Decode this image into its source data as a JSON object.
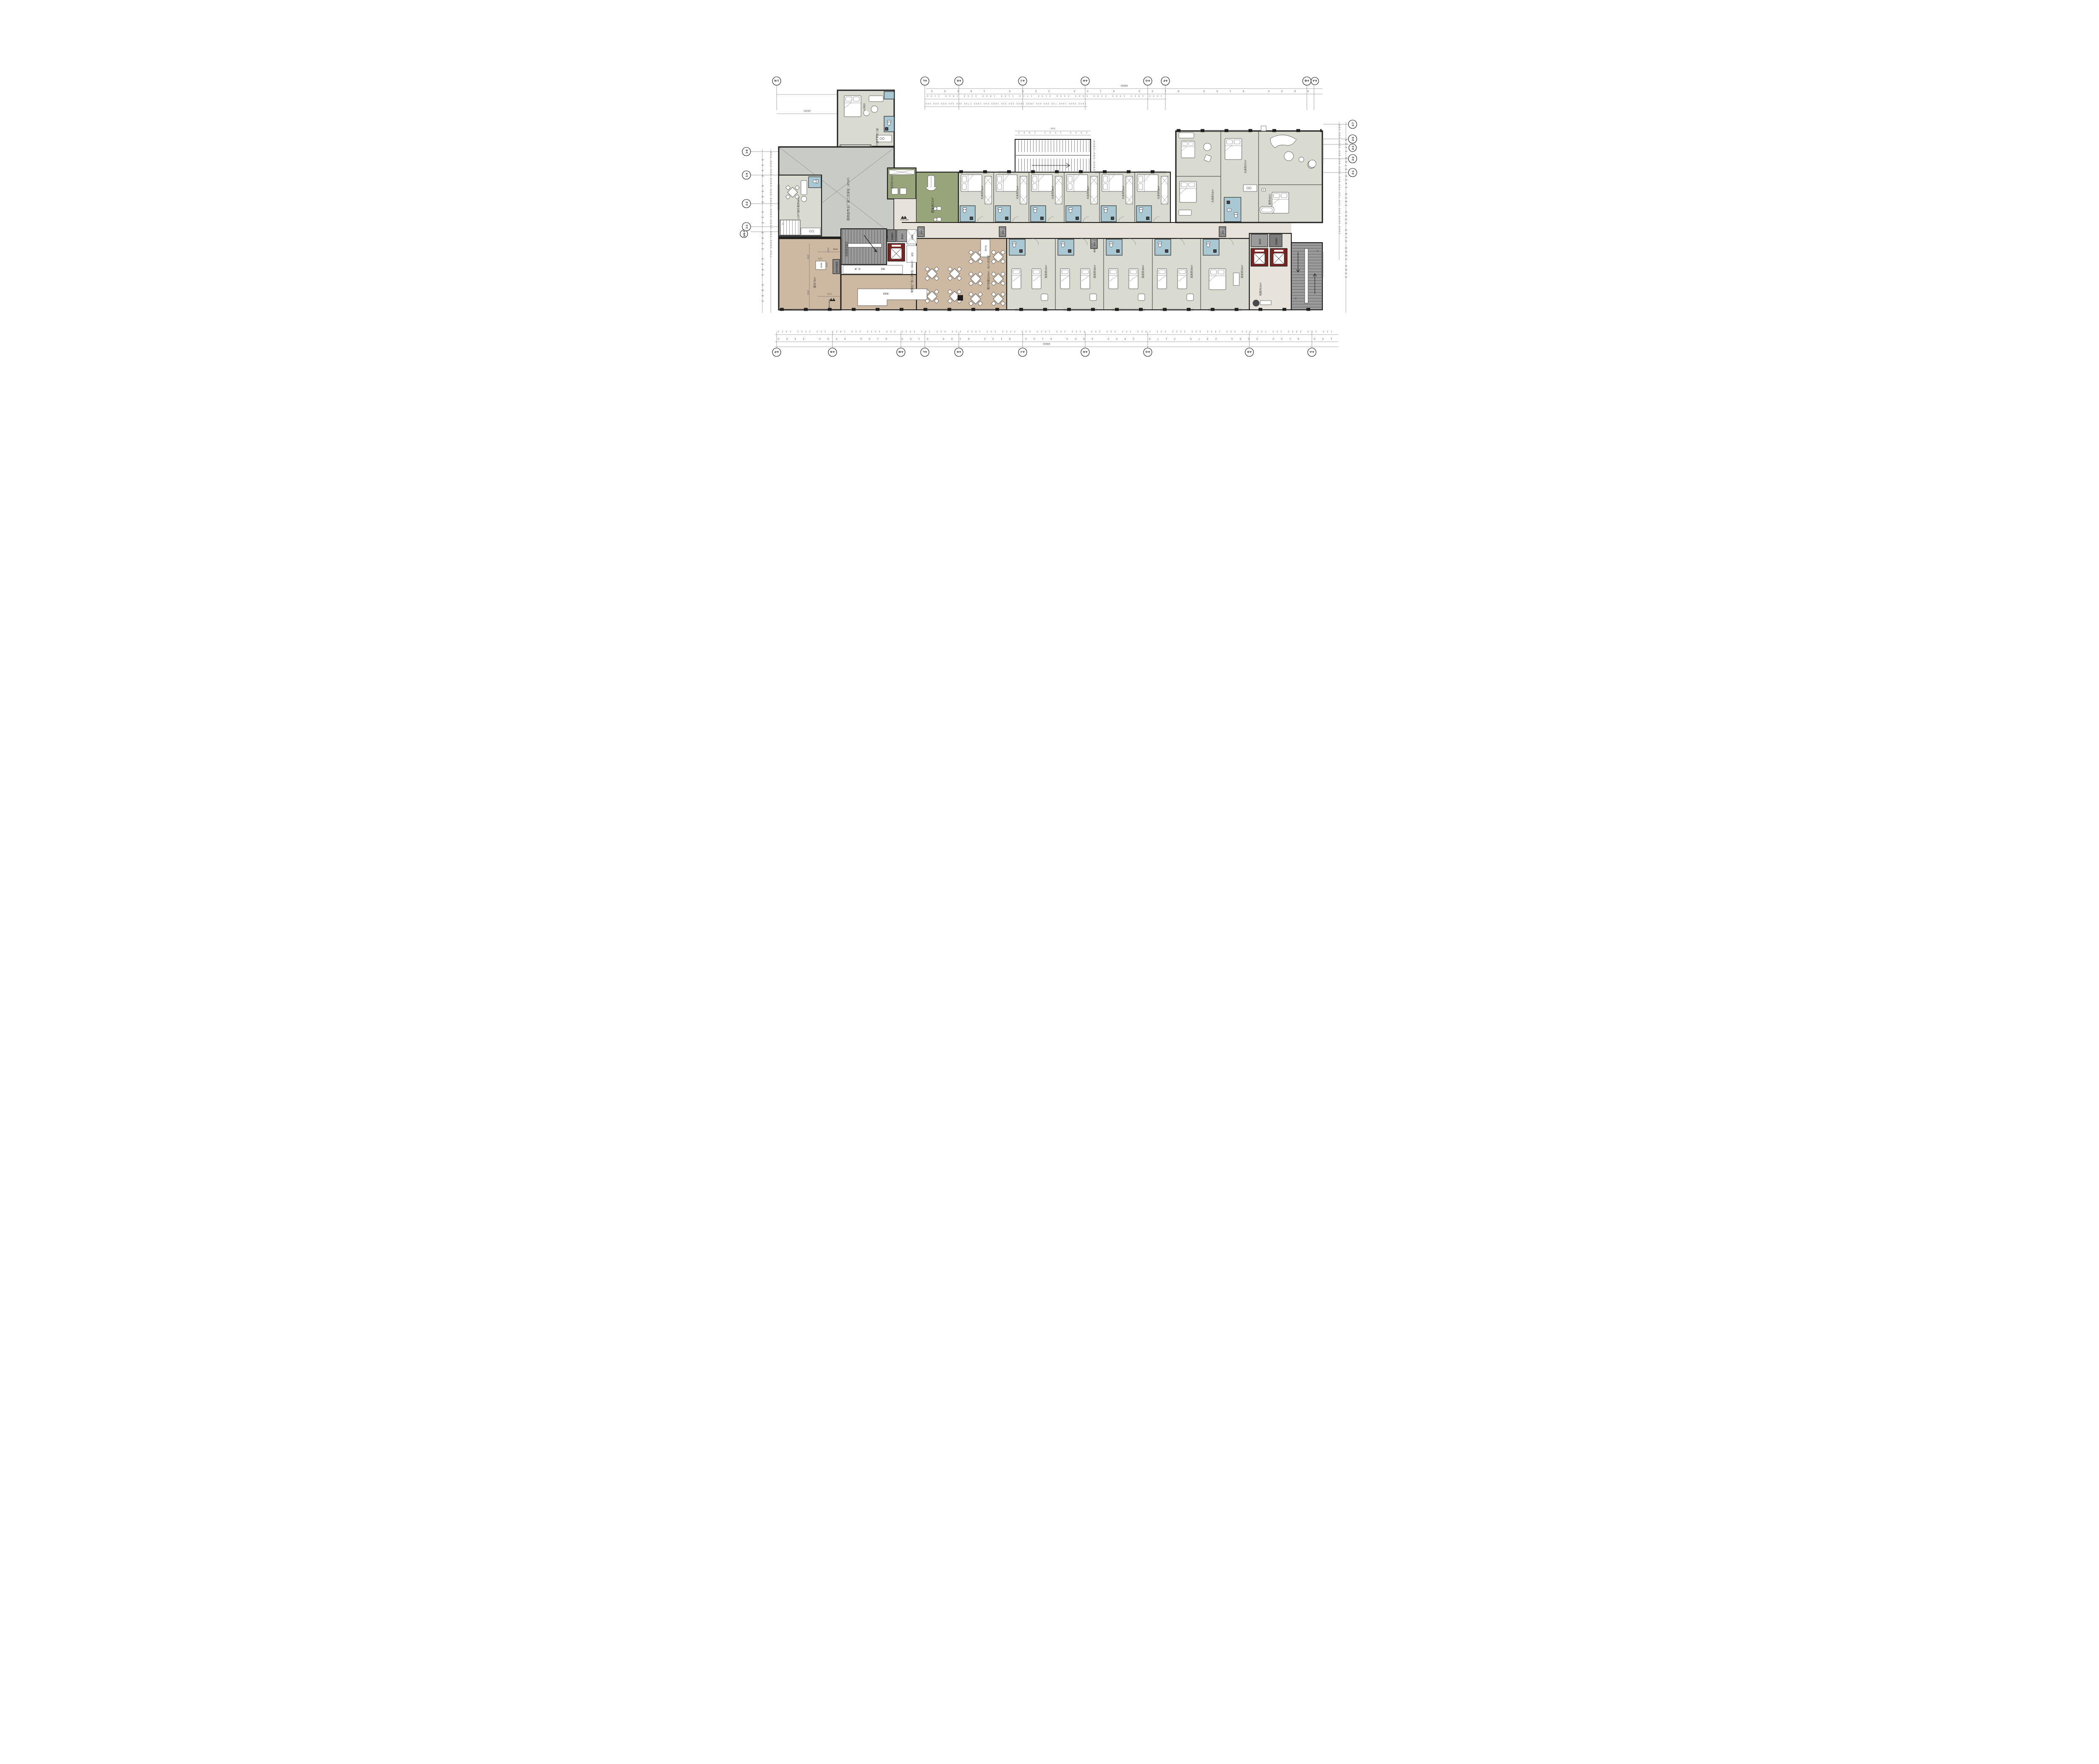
{
  "colors": {
    "room": "#d9dbd1",
    "bath": "#a9c8d3",
    "olive": "#98a57b",
    "tan": "#cdb9a2",
    "corridor": "#e8e3da",
    "core_gray": "#9b9b9b",
    "shaft_gray": "#7c7c7c",
    "void_gray": "#c9ccc6",
    "elevator_red": "#7e2420",
    "wall": "#1d1d1d"
  },
  "grid": {
    "top_labels": [
      "1-N",
      "4-L",
      "4-K",
      "4-J",
      "4-H",
      "4-G",
      "4-F",
      "4-B",
      "4-A"
    ],
    "bottom_labels": [
      "4-P",
      "4-N",
      "4-M",
      "4-L",
      "4-K",
      "4-J",
      "4-H",
      "4-G",
      "4-D",
      "4-A"
    ],
    "left_labels": [
      "1-6",
      "1-4",
      "1-2",
      "1-1",
      "1/4-3"
    ],
    "right_labels": [
      "2-7",
      "2-5",
      "2-3",
      "2-2",
      "2-1"
    ]
  },
  "dims": {
    "total_top": "69600",
    "total_bottom": "69600",
    "block_left": "19000",
    "top_spans": [
      "4600",
      "8100",
      "8100",
      "8100",
      "2250",
      "18000"
    ],
    "top_segs": [
      "1400",
      "1800",
      "1400",
      "2200",
      "5900",
      "3300",
      "3100",
      "1700",
      "1150",
      "1800",
      "2200",
      "1800",
      "1150"
    ],
    "top_fine": [
      "1400",
      "1800",
      "1400",
      "700",
      "900",
      "600",
      "1800",
      "1800",
      "550",
      "350",
      "1400",
      "500",
      "1800",
      "2700",
      "900",
      "300",
      "500",
      "900",
      "500"
    ],
    "bottom_mid": [
      "100",
      "8100",
      "3550",
      "2375",
      "2175",
      "2800",
      "4600",
      "8100",
      "8100",
      "8100",
      "5100",
      "8100",
      "4550",
      "3550"
    ],
    "bottom_fine": [
      "100",
      "500",
      "5800",
      "300",
      "900",
      "300",
      "300",
      "1800",
      "300",
      "3300",
      "300",
      "1800",
      "300",
      "900",
      "300",
      "6000",
      "300",
      "1800",
      "300",
      "3300",
      "300",
      "1800",
      "300",
      "900",
      "300",
      "6000",
      "300",
      "4500",
      "300",
      "1800",
      "300",
      "3550",
      "1400"
    ],
    "left_outer": [
      "3000",
      "3600",
      "3300",
      "250",
      "9800",
      "6400"
    ],
    "left_inner": [
      "750",
      "1500",
      "750",
      "1050",
      "1500",
      "1050",
      "900",
      "1500",
      "900",
      "100",
      "700"
    ],
    "right_outer": [
      "3300",
      "1200",
      "3100",
      "3300",
      "2850",
      "1420",
      "3700",
      "1420"
    ],
    "right_inner": [
      "1600",
      "1800",
      "900",
      "100",
      "700",
      "400",
      "800",
      "1500",
      "800",
      "900",
      "1500",
      "900",
      "250"
    ],
    "stair_total": "6500",
    "stair_segs": [
      "2500",
      "1500",
      "2500"
    ],
    "stair_side": [
      "1500",
      "150",
      "1500"
    ],
    "terrace": [
      "4900",
      "2500",
      "3560",
      "1100",
      "1100",
      "3700"
    ],
    "level": "+2650"
  },
  "rooms": {
    "loft_upper": "LOFT娱乐套房二层",
    "void": "挑空",
    "kitchen_note": "厨房由专业厂家二次深化（47m²）",
    "loft_suite": "LOFT娱乐套房66m²",
    "laundry": "洗衣房10m²",
    "gym": "健身房21m²",
    "king21": "大床房21m²",
    "king26": "大床房26m²",
    "twin33": "双床房33m²",
    "twin36": "双床房36m²",
    "king33": "大床房33m²",
    "king37": "大床房37m²",
    "suite44": "套房44m²",
    "elev_lobby": "电梯间15m²",
    "terrace": "露台73m²",
    "dining": "餐厅就餐区94m²、40人/会议室",
    "pickup": "取餐区厂家二次深化（46m²）"
  },
  "labels": {
    "card_desk": "验卡台",
    "food_counter": "食品台",
    "soup": "汤、粥",
    "bread": "面包",
    "drinks": "软饮",
    "sterilizer": "消毒柜",
    "water_shaft": "水井",
    "exhaust": "排风",
    "power_shaft": "配电井",
    "smoke_shaft": "排油烟井",
    "mech_shaft": "机械通风竖井",
    "fire_duct": "消防排烟烟道",
    "extinguisher": "MF/ABC5",
    "door_code": "2FM1",
    "h300": "H/300",
    "up": "上",
    "down": "下"
  }
}
